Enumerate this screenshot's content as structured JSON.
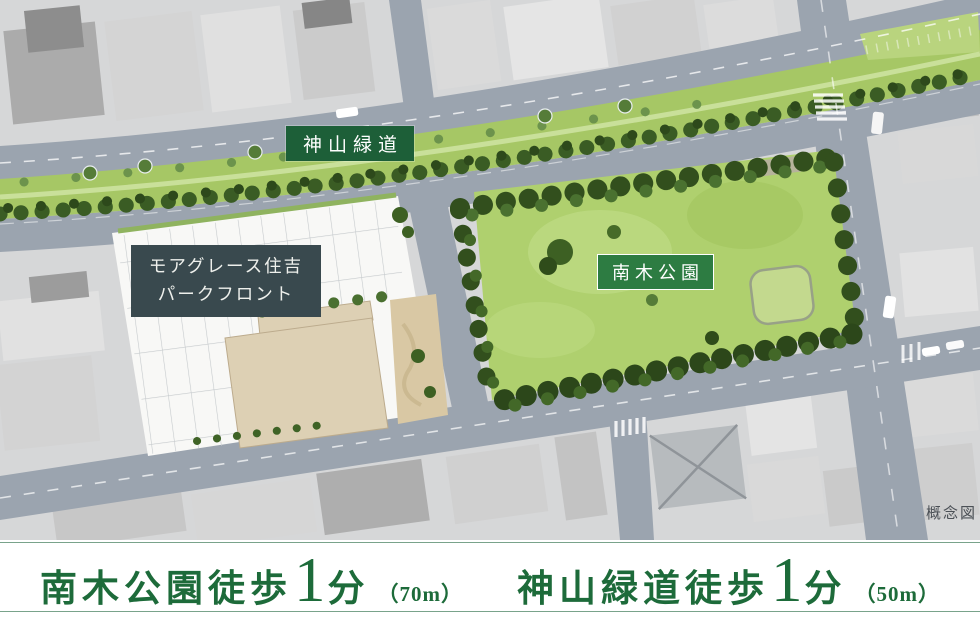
{
  "map": {
    "signs": {
      "greenway": {
        "label": "神山緑道"
      },
      "property": {
        "line1": "モアグレース住吉",
        "line2": "パークフロント"
      },
      "park": {
        "label": "南木公園"
      },
      "note": {
        "label": "概念図"
      }
    },
    "colors": {
      "road": "#9ba4af",
      "greenway_grass": "#a6c765",
      "park_grass": "#afd06e",
      "tree_dark": "#33511e",
      "tree_mid": "#486f2c",
      "site_white": "#f8f8f6",
      "building_beige": "#ddd0b4",
      "greenway_sign_bg": "#1d5f38",
      "park_sign_bg": "#2d7c42",
      "property_sign_bg": "#39494e",
      "banner_text": "#1d6b3a",
      "banner_line": "#79a38b"
    }
  },
  "banner": {
    "items": [
      {
        "prefix": "南木公園徒歩",
        "number": "1",
        "unit": "分",
        "distance": "（70m）"
      },
      {
        "prefix": "神山緑道徒歩",
        "number": "1",
        "unit": "分",
        "distance": "（50m）"
      }
    ]
  }
}
